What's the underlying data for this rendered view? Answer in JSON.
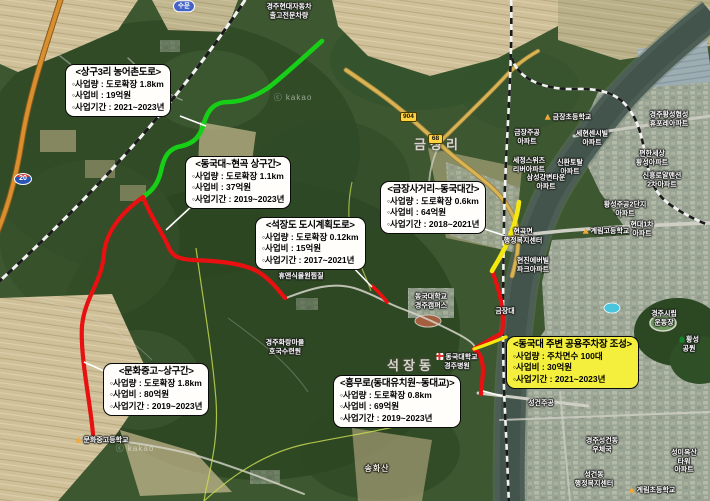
{
  "map": {
    "kind": "satellite-road-project-map",
    "attribution": "ⓒ kakao"
  },
  "colors": {
    "project_green": "#17cf17",
    "project_red": "#e81010",
    "project_yellow": "#f4e80e",
    "highlight_box_bg": "#f3ef3c",
    "box_bg": "#fffefb"
  },
  "project_boxes": [
    {
      "title": "<상구3리 농어촌도로>",
      "items": [
        "◦사업량 : 도로확장 1.8km",
        "◦사업비 : 19억원",
        "◦사업기간 : 2021~2023년"
      ],
      "highlight": false
    },
    {
      "title": "<동국대~현곡 상구간>",
      "items": [
        "◦사업량 : 도로확장 1.1km",
        "◦사업비 : 37억원",
        "◦사업기간 : 2019~2023년"
      ],
      "highlight": false
    },
    {
      "title": "<석장도 도시계획도로>",
      "items": [
        "◦사업량 : 도로확장 0.12km",
        "◦사업비 : 15억원",
        "◦사업기간 : 2017~2021년"
      ],
      "highlight": false
    },
    {
      "title": "<금장사거리~동국대간>",
      "items": [
        "◦사업량 : 도로확장 0.6km",
        "◦사업비 : 64억원",
        "◦사업기간 : 2018~2021년"
      ],
      "highlight": false
    },
    {
      "title": "<동국대 주변 공용주차장 조성>",
      "items": [
        "◦사업량 : 주차면수 100대",
        "◦사업비 : 30억원",
        "◦사업기간 : 2021~2023년"
      ],
      "highlight": true
    },
    {
      "title": "<문화중고~상구간>",
      "items": [
        "◦사업량 : 도로확장 1.8km",
        "◦사업비 : 80억원",
        "◦사업기간 : 2019~2023년"
      ],
      "highlight": false
    },
    {
      "title": "<흥무로(동대유치원~동대교)>",
      "items": [
        "◦사업량 : 도로확장 0.8km",
        "◦사업비 : 69억원",
        "◦사업기간 : 2019~2023년"
      ],
      "highlight": false
    }
  ],
  "road_shields": [
    {
      "number": "20",
      "type": "expressway"
    },
    {
      "number": "904",
      "type": "local"
    },
    {
      "number": "68",
      "type": "local"
    }
  ],
  "map_labels": [
    {
      "text": "수문",
      "x": 184,
      "y": 6,
      "kind": "pill"
    },
    {
      "text": "경주현대자동차\n출고전문차량",
      "x": 289,
      "y": 12,
      "kind": "poi"
    },
    {
      "text": "금장초등학교",
      "x": 568,
      "y": 118,
      "kind": "poi",
      "icon": "school"
    },
    {
      "text": "경주황성협성\n휴포레아파트",
      "x": 669,
      "y": 120,
      "kind": "poi"
    },
    {
      "text": "금장주공\n아파트",
      "x": 527,
      "y": 138,
      "kind": "poi"
    },
    {
      "text": "세현센시빌\n아파트",
      "x": 592,
      "y": 139,
      "kind": "poi"
    },
    {
      "text": "세정스위츠\n리버아파트",
      "x": 529,
      "y": 166,
      "kind": "poi"
    },
    {
      "text": "신환토탈\n아파트",
      "x": 570,
      "y": 168,
      "kind": "poi"
    },
    {
      "text": "편한세상\n황성아파트",
      "x": 652,
      "y": 159,
      "kind": "poi"
    },
    {
      "text": "신흥로얄맨션\n2차아파트",
      "x": 662,
      "y": 181,
      "kind": "poi"
    },
    {
      "text": "삼성강변타운\n아파트",
      "x": 546,
      "y": 183,
      "kind": "poi"
    },
    {
      "text": "황성주공2단지\n아파트",
      "x": 625,
      "y": 210,
      "kind": "poi"
    },
    {
      "text": "현대1차\n아파트",
      "x": 642,
      "y": 230,
      "kind": "poi"
    },
    {
      "text": "계림고등학교",
      "x": 606,
      "y": 232,
      "kind": "poi",
      "icon": "school"
    },
    {
      "text": "서경주역",
      "x": 467,
      "y": 200,
      "kind": "pill"
    },
    {
      "text": "금장리",
      "x": 438,
      "y": 145,
      "kind": "area"
    },
    {
      "text": "현곡면\n행정복지센터",
      "x": 523,
      "y": 237,
      "kind": "poi"
    },
    {
      "text": "현진에버빌\n파크아파트",
      "x": 533,
      "y": 266,
      "kind": "poi"
    },
    {
      "text": "금장대",
      "x": 505,
      "y": 312,
      "kind": "poi"
    },
    {
      "text": "동국대학교\n경주캠퍼스",
      "x": 431,
      "y": 302,
      "kind": "poi"
    },
    {
      "text": "동국대학교\n경주병원",
      "x": 457,
      "y": 362,
      "kind": "poi",
      "icon": "hospital"
    },
    {
      "text": "석장동",
      "x": 411,
      "y": 366,
      "kind": "area"
    },
    {
      "text": "경주시립\n운동장",
      "x": 664,
      "y": 319,
      "kind": "poi"
    },
    {
      "text": "황성공원",
      "x": 689,
      "y": 345,
      "kind": "poi",
      "icon": "tree"
    },
    {
      "text": "성건주공",
      "x": 541,
      "y": 404,
      "kind": "poi"
    },
    {
      "text": "경주성건동\n우체국",
      "x": 602,
      "y": 446,
      "kind": "poi"
    },
    {
      "text": "성미옥산타워\n아파트",
      "x": 684,
      "y": 462,
      "kind": "poi"
    },
    {
      "text": "성건동\n행정복지센터",
      "x": 594,
      "y": 480,
      "kind": "poi"
    },
    {
      "text": "계림초등학교",
      "x": 652,
      "y": 491,
      "kind": "poi",
      "icon": "school"
    },
    {
      "text": "송화산",
      "x": 377,
      "y": 469,
      "kind": "peak"
    },
    {
      "text": "문화중고등학교",
      "x": 102,
      "y": 441,
      "kind": "poi",
      "icon": "school"
    },
    {
      "text": "경주화랑마을\n호국수련원",
      "x": 285,
      "y": 348,
      "kind": "poi"
    },
    {
      "text": "휴앤식물원찜질",
      "x": 301,
      "y": 277,
      "kind": "poi"
    },
    {
      "text": "ⓒ kakao",
      "x": 293,
      "y": 98,
      "kind": "watermark"
    },
    {
      "text": "ⓒ kakao",
      "x": 135,
      "y": 449,
      "kind": "watermark"
    }
  ]
}
